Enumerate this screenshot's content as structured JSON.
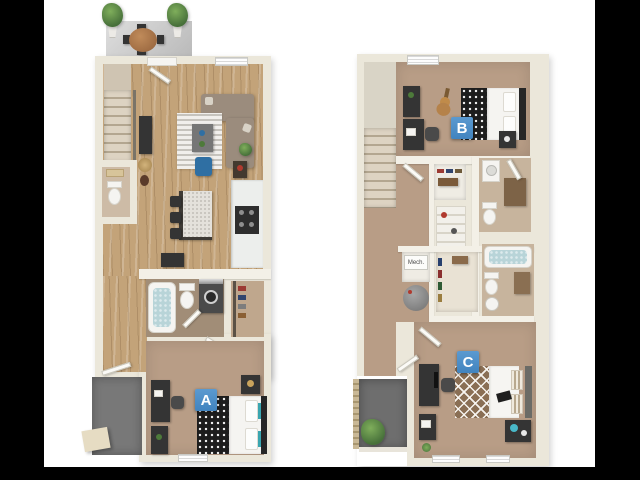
{
  "image": {
    "kind": "3d-floor-plan-rendering",
    "plans": [
      "first-floor",
      "second-floor"
    ],
    "background": "#ffffff"
  },
  "markers": {
    "a": "A",
    "b": "B",
    "c": "C"
  },
  "labels": {
    "mech": "Mech."
  },
  "colors": {
    "letterbox": "#000000",
    "marker_blue": "#4184bf",
    "wall": "#ebe7da",
    "wall_inner": "#f3f0e7",
    "wood": "#c3a379",
    "carpet": "#b89d86",
    "bath_floor_dark": "#a18d77",
    "bath_floor_light": "#c7b49d",
    "patio": "#787878",
    "balcony": "#6e6e6e",
    "water_blue": "#b8d4d8",
    "accent_chair": "#2f6fa3",
    "sofa": "#9b8c7d",
    "duvet_dark": "#1d1d1d",
    "duvet_brown": "#8a6f55"
  }
}
